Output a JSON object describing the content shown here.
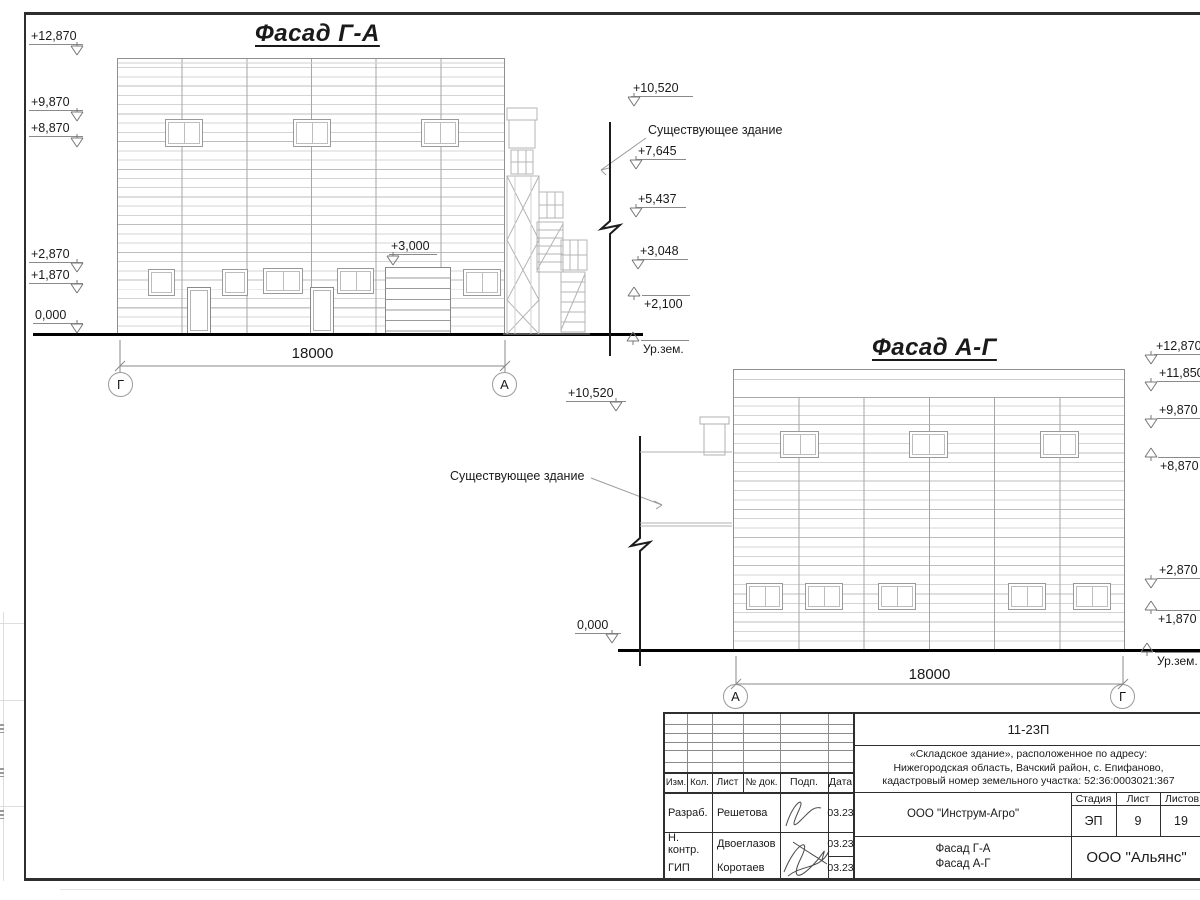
{
  "facade1": {
    "title": "Фасад Г-А",
    "elevations_left": [
      "+12,870",
      "+9,870",
      "+8,870",
      "+2,870",
      "+1,870",
      "0,000"
    ],
    "gate_elevation": "+3,000",
    "dimension": "18000",
    "axis_left": "Г",
    "axis_right": "А"
  },
  "annotations_mid": {
    "elev_top": "+10,520",
    "existing_building": "Существующее здание",
    "elev_1": "+7,645",
    "elev_2": "+5,437",
    "elev_3": "+3,048",
    "elev_4": "+2,100",
    "ground_label": "Ур.зем."
  },
  "facade2": {
    "title": "Фасад А-Г",
    "elev_top_left": "+10,520",
    "existing_building": "Существующее здание",
    "elev_zero": "0,000",
    "elevations_right": [
      "+12,870",
      "+11,850",
      "+9,870",
      "+8,870",
      "+2,870",
      "+1,870"
    ],
    "dimension": "18000",
    "axis_left": "А",
    "axis_right": "Г",
    "ground_label": "Ур.зем."
  },
  "titleblock": {
    "doc_number": "11-23П",
    "address_line1": "«Складское здание», расположенное по адресу:",
    "address_line2": "Нижегородская область, Вачский район, с. Епифаново,",
    "address_line3": "кадастровый номер земельного участка: 52:36:0003021:367",
    "columns": [
      "Изм.",
      "Кол.",
      "Лист",
      "№ док.",
      "Подп.",
      "Дата"
    ],
    "rows": [
      {
        "role": "Разраб.",
        "name": "Решетова",
        "date": "03.23"
      },
      {
        "role": "Н. контр.",
        "name": "Двоеглазов",
        "date": "03.23"
      },
      {
        "role": "ГИП",
        "name": "Коротаев",
        "date": "03.23"
      }
    ],
    "organization": "ООО \"Инструм-Агро\"",
    "stage_columns": [
      "Стадия",
      "Лист",
      "Листов"
    ],
    "stage": "ЭП",
    "sheet_no": "9",
    "sheets_total": "19",
    "drawing_title_line1": "Фасад Г-А",
    "drawing_title_line2": "Фасад А-Г",
    "company": "ООО \"Альянс\""
  }
}
